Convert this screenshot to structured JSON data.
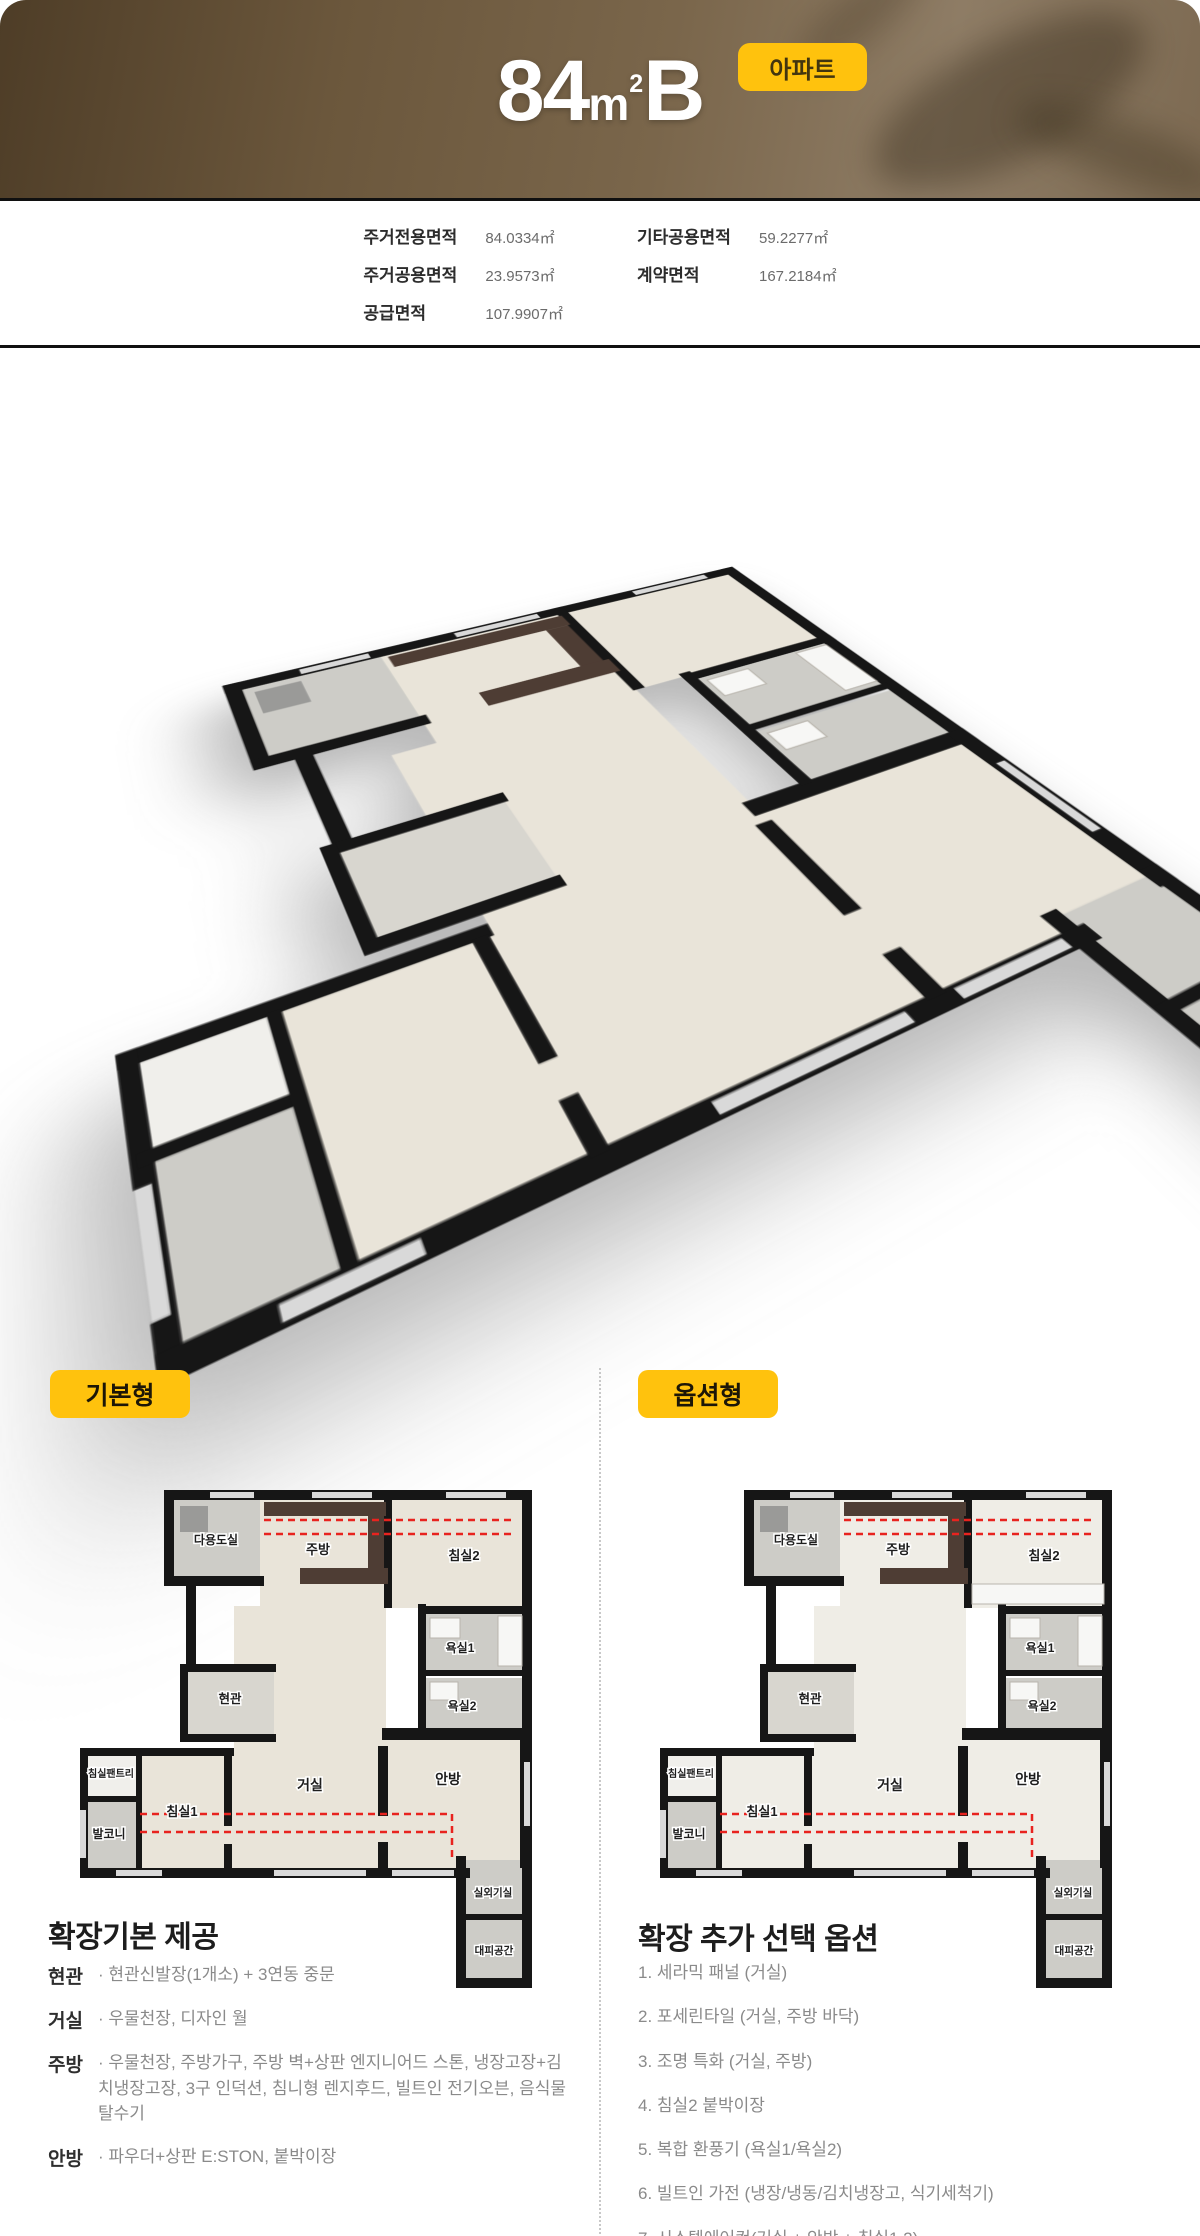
{
  "header": {
    "title_number": "84",
    "title_unit": "m",
    "title_unit_sup": "2",
    "title_type": "B",
    "badge_label": "아파트",
    "colors": {
      "badge_bg": "#ffc20d",
      "badge_text": "#42350f",
      "bg_brown": "#75614a"
    }
  },
  "area_info": {
    "columns": [
      {
        "rows": [
          {
            "label": "주거전용면적",
            "value": "84.0334㎡"
          },
          {
            "label": "주거공용면적",
            "value": "23.9573㎡"
          },
          {
            "label": "공급면적",
            "value": "107.9907㎡"
          }
        ]
      },
      {
        "rows": [
          {
            "label": "기타공용면적",
            "value": "59.2277㎡"
          },
          {
            "label": "계약면적",
            "value": "167.2184㎡"
          }
        ]
      }
    ]
  },
  "plan_types": {
    "basic_label": "기본형",
    "option_label": "옵션형",
    "badge_bg": "#ffc20d",
    "badge_text": "#1c1607"
  },
  "floor_plan": {
    "rooms": [
      {
        "id": "utility",
        "label": "다용도실"
      },
      {
        "id": "kitchen",
        "label": "주방"
      },
      {
        "id": "bed2",
        "label": "침실2"
      },
      {
        "id": "bath1",
        "label": "욕실1"
      },
      {
        "id": "bath2",
        "label": "욕실2"
      },
      {
        "id": "entry",
        "label": "현관"
      },
      {
        "id": "pantry",
        "label": "침실팬트리"
      },
      {
        "id": "balcony",
        "label": "발코니"
      },
      {
        "id": "bed1",
        "label": "침실1"
      },
      {
        "id": "living",
        "label": "거실"
      },
      {
        "id": "master",
        "label": "안방"
      },
      {
        "id": "outdoor",
        "label": "실외기실"
      },
      {
        "id": "shelter",
        "label": "대피공간"
      }
    ],
    "colors": {
      "wall": "#161616",
      "floor": "#e9e4d9",
      "option_floor": "#efede6",
      "tile": "#cdccc7",
      "entry_tile": "#d8d6cf",
      "pantry_fill": "#f0efeb",
      "wood": "#4e3d34",
      "window": "#d9d9d9",
      "fixture": "#f7f7f5",
      "washer": "#9a9a98",
      "red": "#e8231f",
      "label": "#1e1e1e"
    }
  },
  "provided": {
    "heading": "확장기본 제공",
    "items": [
      {
        "label": "현관",
        "text": "· 현관신발장(1개소) + 3연동 중문"
      },
      {
        "label": "거실",
        "text": "· 우물천장, 디자인 월"
      },
      {
        "label": "주방",
        "text": "· 우물천장, 주방가구, 주방 벽+상판 엔지니어드 스톤, 냉장고장+김치냉장고장, 3구 인덕션, 침니형 렌지후드, 빌트인 전기오븐, 음식물 탈수기"
      },
      {
        "label": "안방",
        "text": "· 파우더+상판 E:STON, 붙박이장"
      }
    ]
  },
  "options": {
    "heading": "확장 추가 선택 옵션",
    "items": [
      "1. 세라믹 패널 (거실)",
      "2. 포세린타일 (거실, 주방 바닥)",
      "3. 조명 특화 (거실, 주방)",
      "4. 침실2 붙박이장",
      "5. 복합 환풍기 (욕실1/욕실2)",
      "6. 빌트인 가전 (냉장/냉동/김치냉장고, 식기세척기)",
      "7. 시스템에어컨(거실 + 안방 + 침실1,2)"
    ]
  }
}
